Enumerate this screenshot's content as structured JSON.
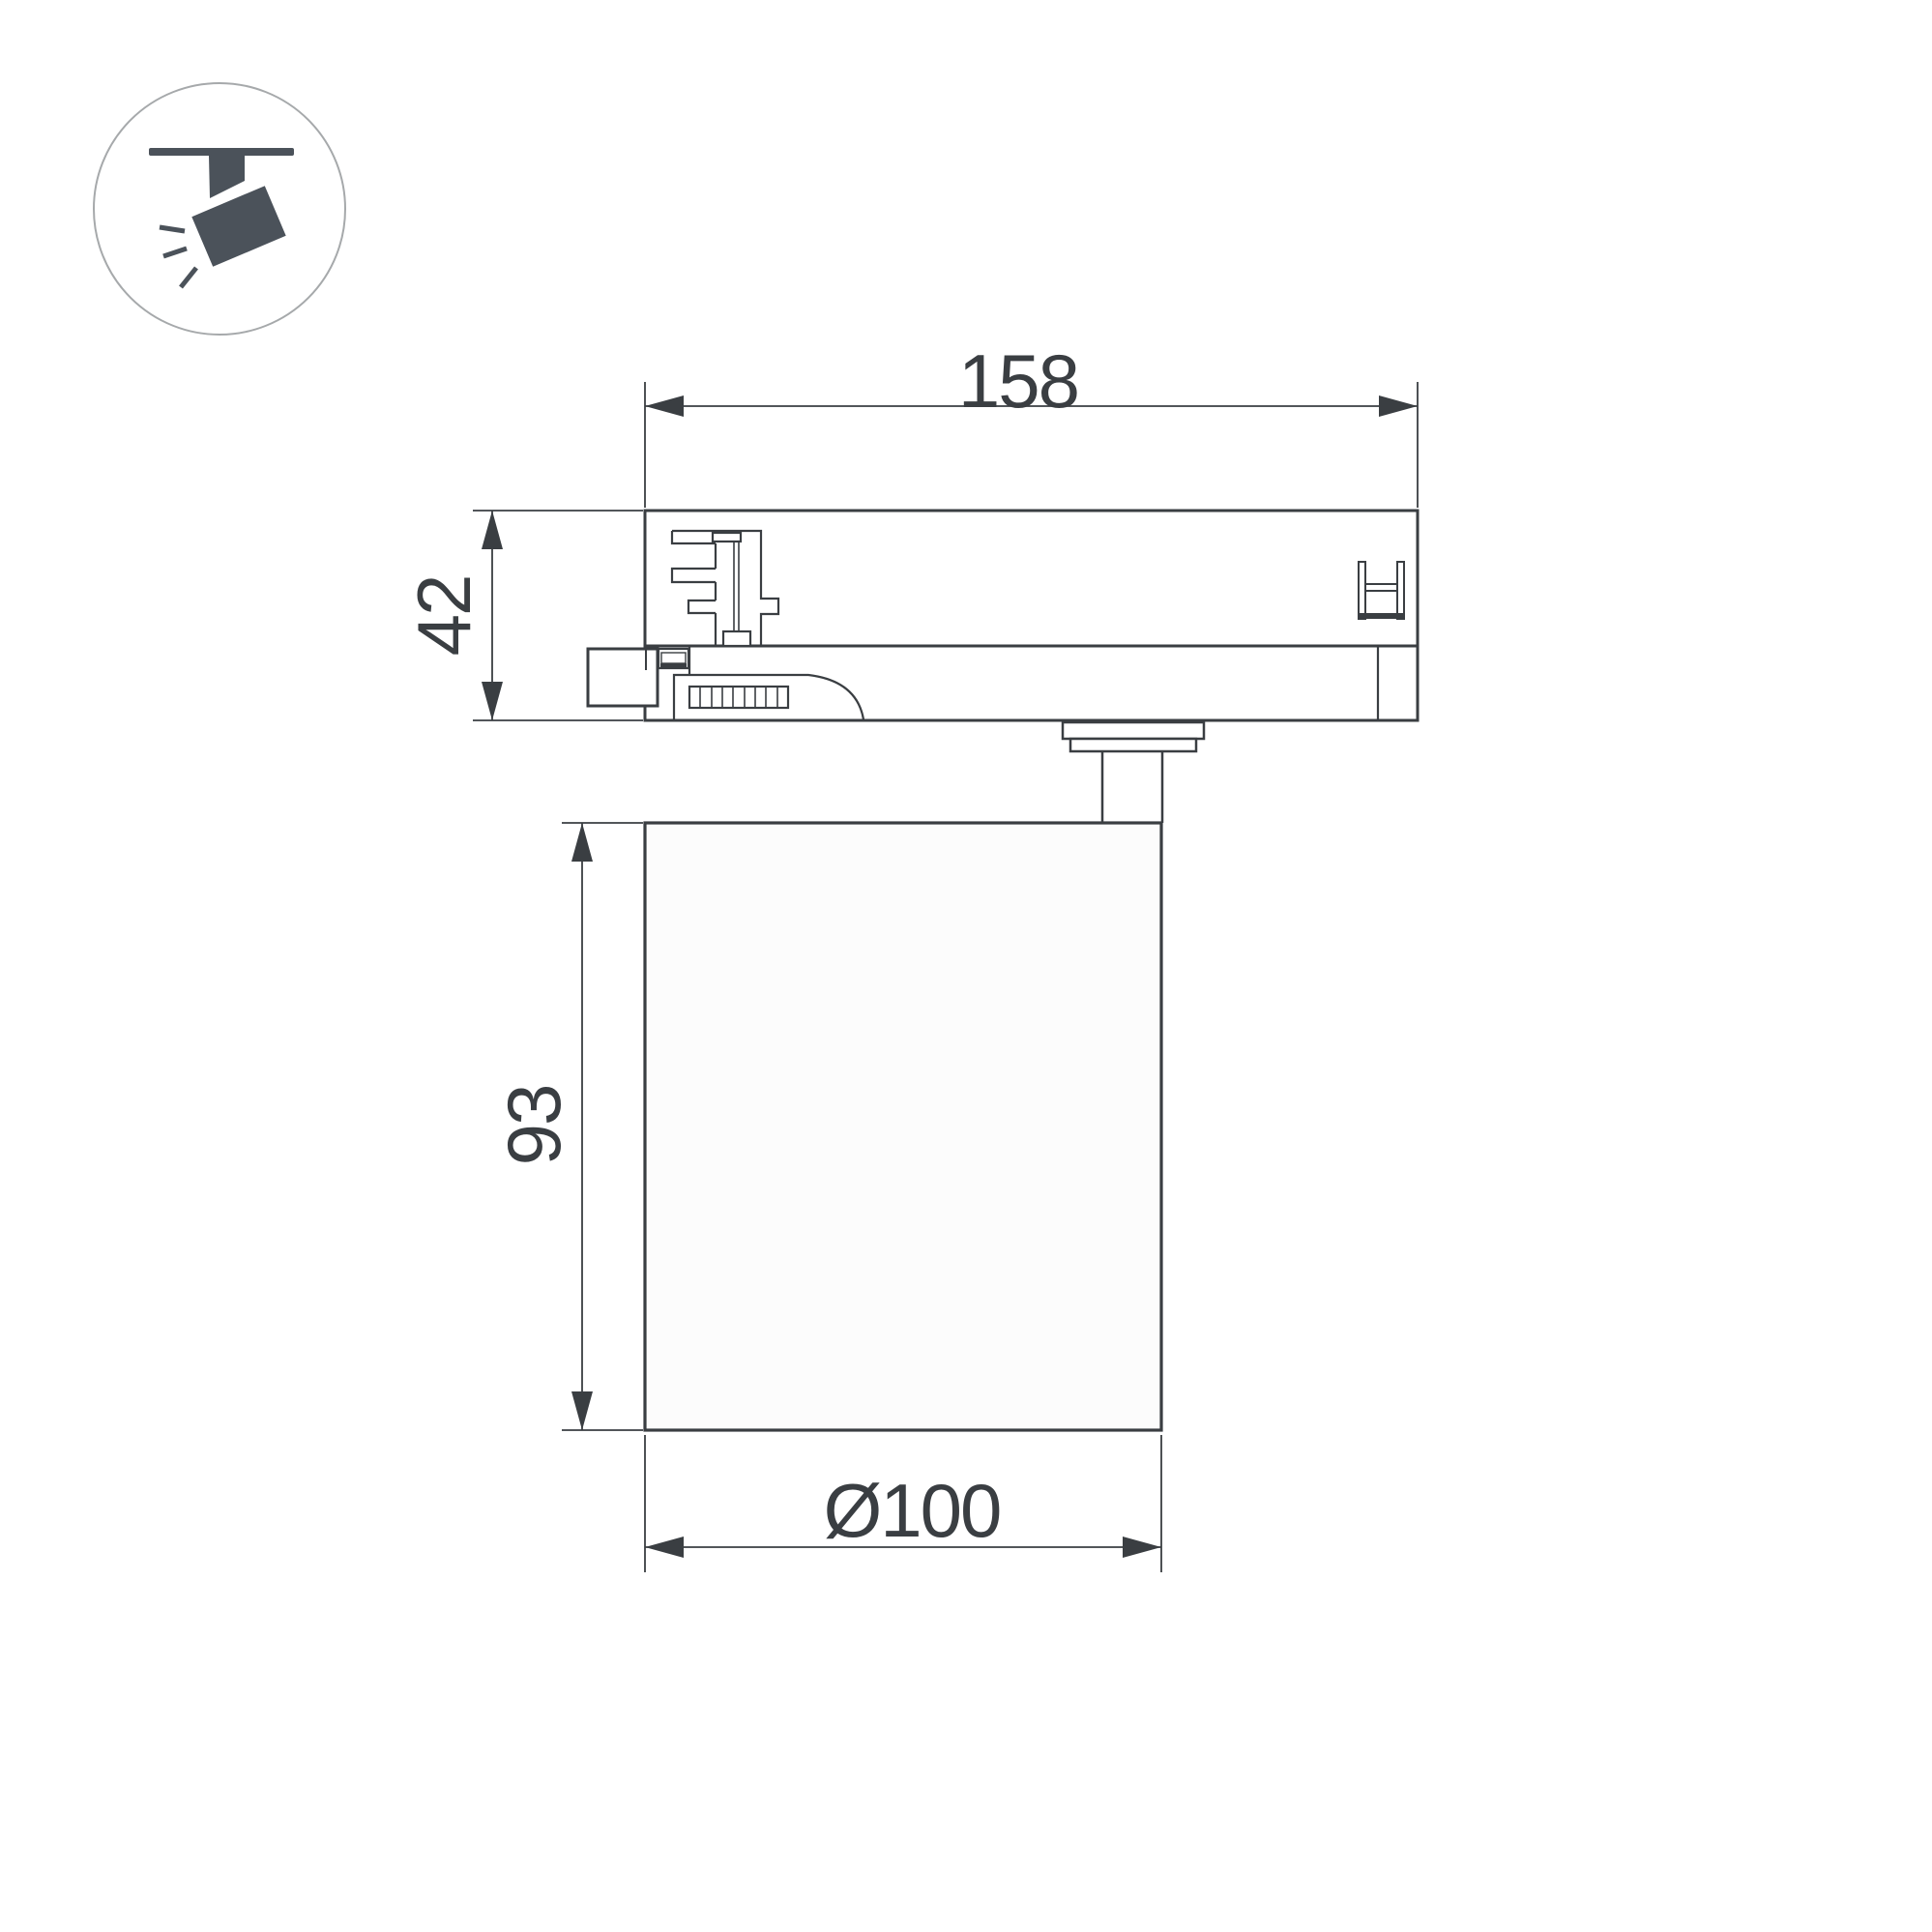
{
  "page": {
    "background": "#ffffff"
  },
  "colors": {
    "surface": "#ffffff",
    "line": "#3a3e42",
    "text": "#3a3e42",
    "cylinder_fill": "#fcfcfc",
    "icon_glyph": "#4b525a",
    "icon_circle": "#a6a9ab"
  },
  "icon": {
    "name": "track-spotlight-icon"
  },
  "drawing": {
    "dimensions": {
      "track_width": {
        "label": "158"
      },
      "adapter_height": {
        "label": "42"
      },
      "body_height": {
        "label": "93"
      },
      "body_diameter": {
        "label": "Ø100"
      }
    }
  }
}
